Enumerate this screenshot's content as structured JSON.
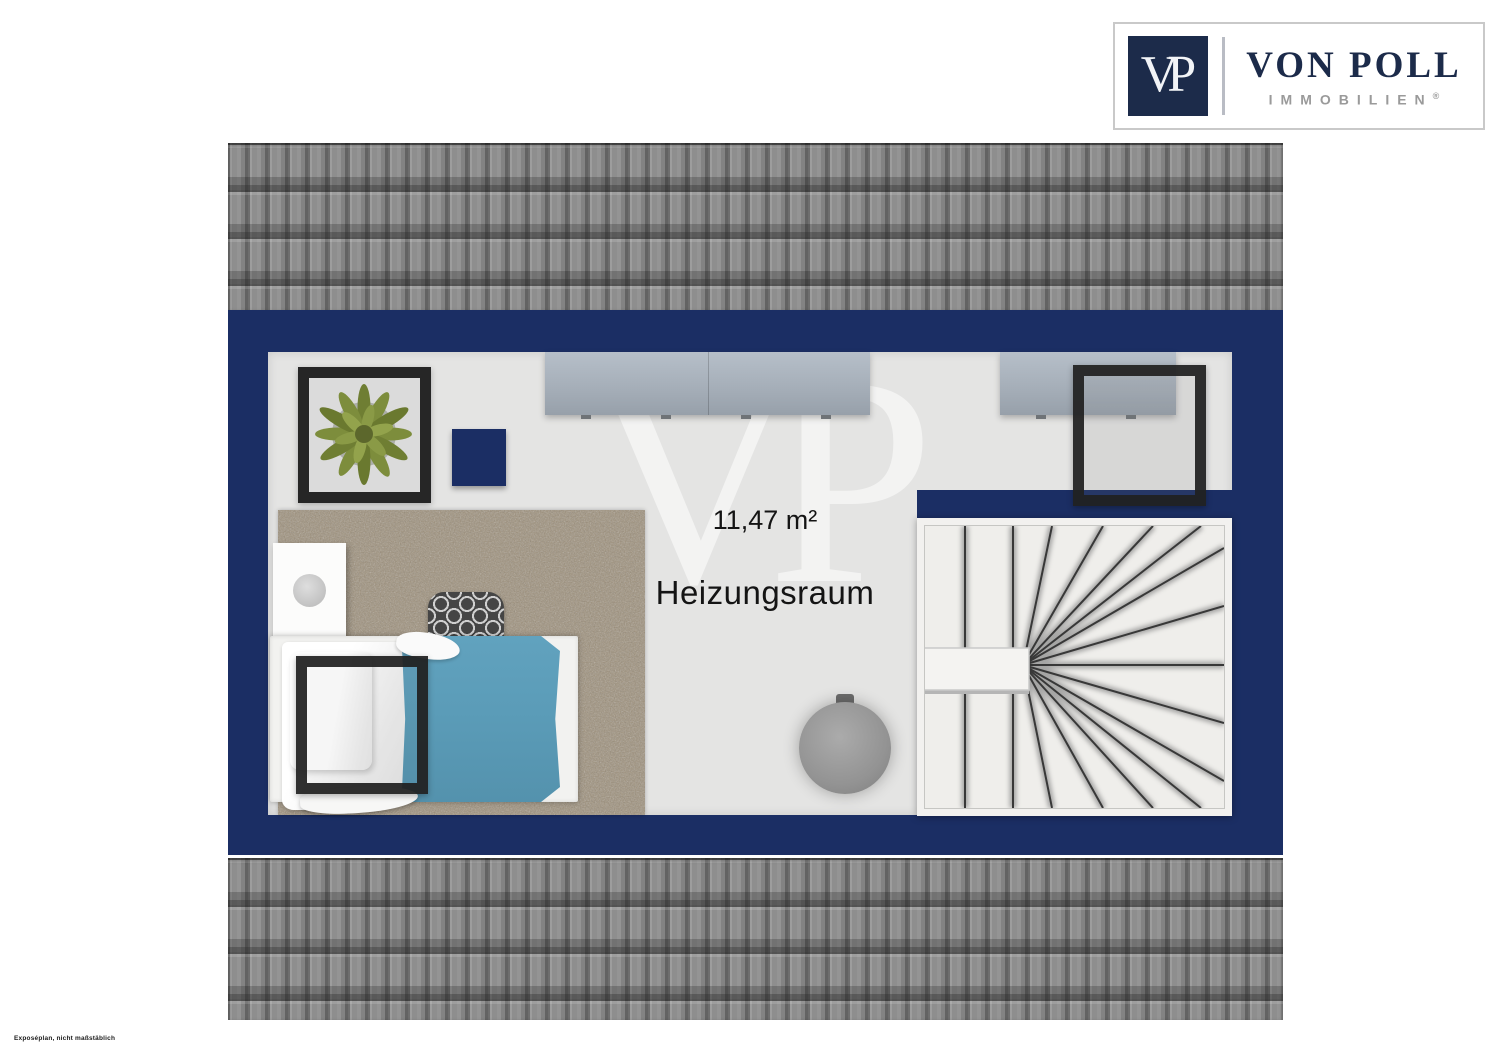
{
  "branding": {
    "logo_initials": "VP",
    "brand_name": "VON POLL",
    "brand_subtitle": "IMMOBILIEN",
    "registered_mark": "®"
  },
  "room": {
    "area_label": "11,47 m²",
    "room_name": "Heizungsraum",
    "watermark": "VP"
  },
  "footer": {
    "disclaimer": "Exposéplan, nicht maßstäblich"
  },
  "colors": {
    "wall_navy": "#1b2e64",
    "logo_navy": "#1c2b4a",
    "floor_gray": "#e4e4e3",
    "roof_gray": "#8c8c8c",
    "carpet_brown": "#9d8f79",
    "blanket_teal": "#5b9cb8",
    "window_frame_black": "#262626",
    "subtitle_gray": "#9a9a9a"
  },
  "objects": [
    "framed-plant",
    "navy-stool",
    "sideboard-left",
    "sideboard-right",
    "shag-rug",
    "nightstand-with-lamp",
    "single-bed-white-and-teal",
    "patterned-armchair",
    "roof-window-over-bed",
    "roof-window-top-right",
    "heating-tank",
    "winder-staircase",
    "handrail"
  ]
}
